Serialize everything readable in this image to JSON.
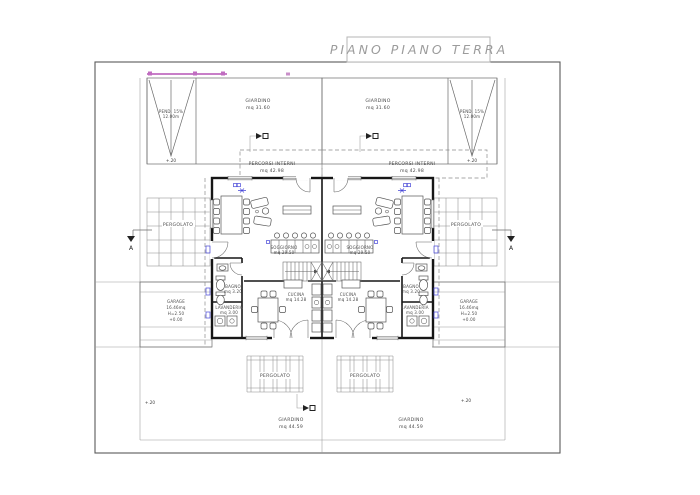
{
  "title": "PIANO PIANO TERRA",
  "colors": {
    "wall": "#161616",
    "line": "#6b6b6b",
    "accent_blue": "#4646d8",
    "accent_magenta": "#c06cc0",
    "title_gray": "#9c9c9c"
  },
  "section_marker": {
    "letter": "A"
  },
  "levels": {
    "garden": "+.20"
  },
  "areas": {
    "garden_top": {
      "name": "GIARDINO",
      "area": "mq 31.60"
    },
    "paths": {
      "name": "PERCORSI  INTERNI",
      "area": "mq 42.98"
    },
    "pergolato": {
      "name": "PERGOLATO"
    },
    "garage": {
      "name": "GARAGE",
      "area": "16.46mq",
      "height": "H=2.50",
      "level": "+0.00"
    },
    "garden_bottom": {
      "name": "GIARDINO",
      "area": "mq 44.59"
    },
    "living": {
      "name": "SOGGIORNO",
      "area": "mq 29.50"
    },
    "kitchen": {
      "name": "CUCINA",
      "area": "mq 14.28"
    },
    "bath": {
      "name": "BAGNO",
      "area": "mq 3.20"
    },
    "laundry": {
      "name": "LAVANDERIA",
      "area": "mq 3.00"
    },
    "ramp": {
      "line1": "PEND. 15%",
      "line2": "12.00m"
    }
  }
}
